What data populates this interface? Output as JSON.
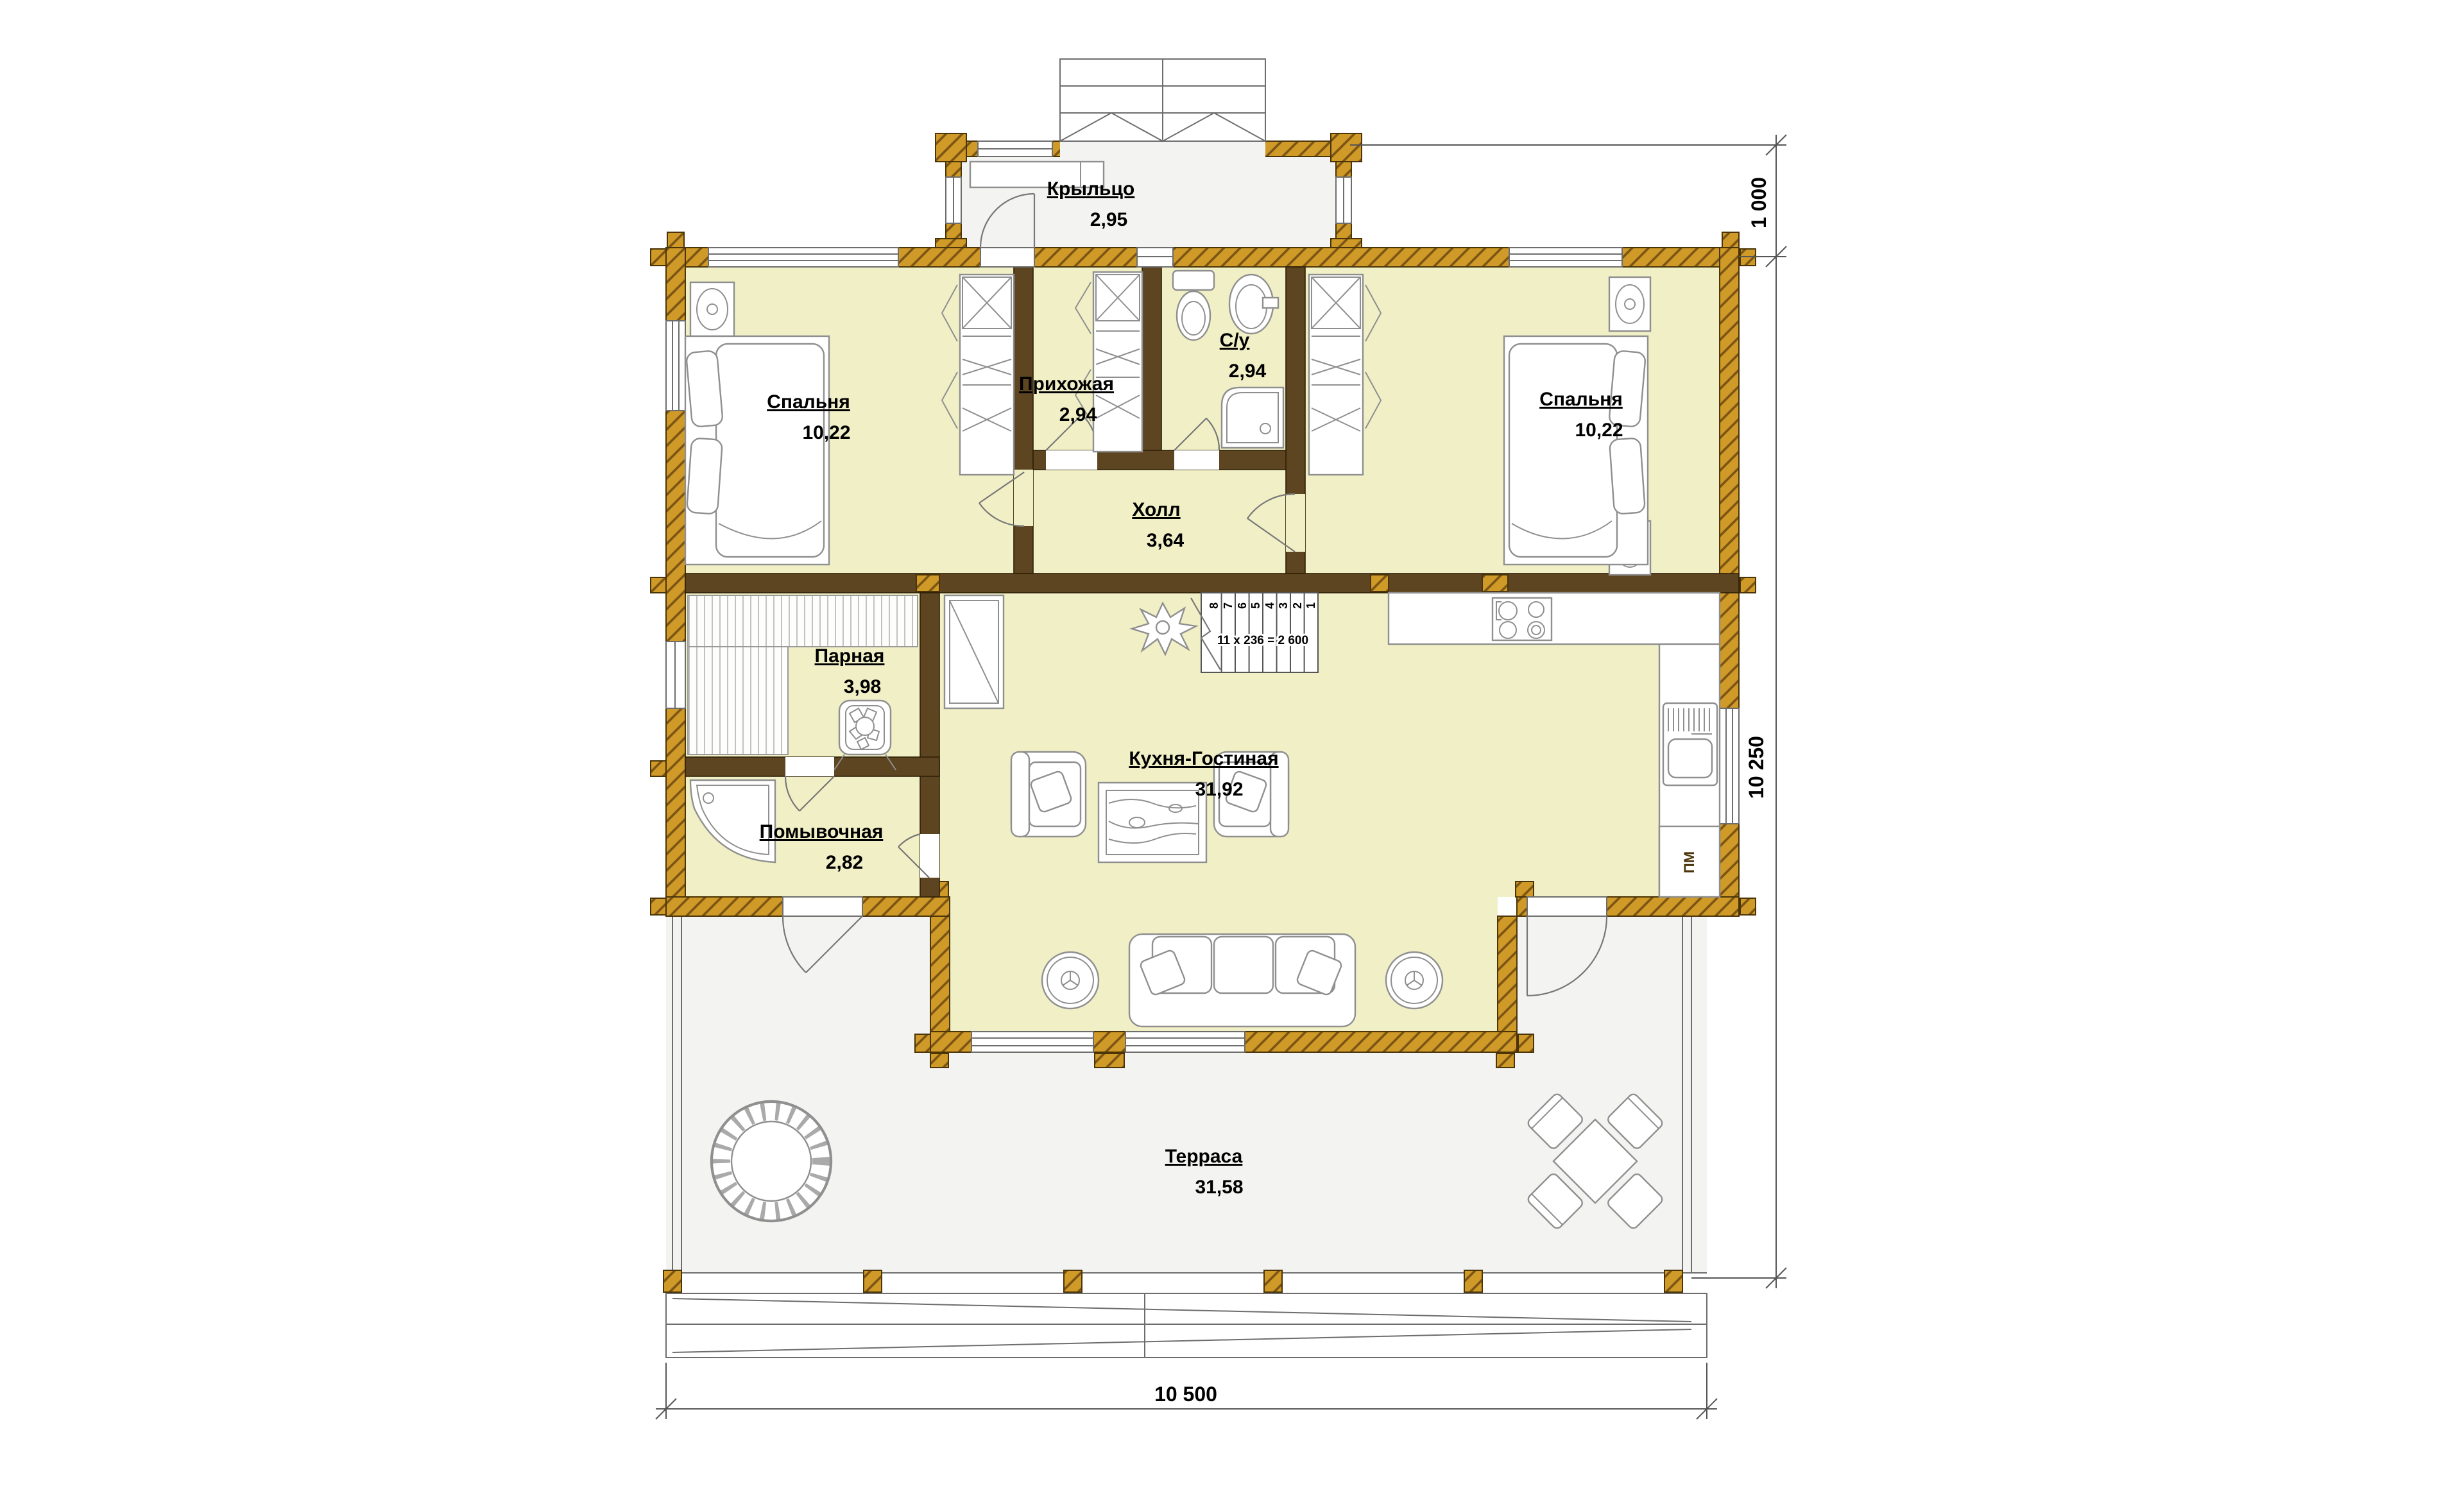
{
  "plan": {
    "rooms": {
      "porch": {
        "name": "Крыльцо",
        "area": "2,95"
      },
      "hallway": {
        "name": "Прихожая",
        "area": "2,94"
      },
      "bathroom": {
        "name": "С/у",
        "area": "2,94"
      },
      "bedroom_left": {
        "name": "Спальня",
        "area": "10,22"
      },
      "bedroom_right": {
        "name": "Спальня",
        "area": "10,22"
      },
      "hall": {
        "name": "Холл",
        "area": "3,64"
      },
      "sauna": {
        "name": "Парная",
        "area": "3,98"
      },
      "washroom": {
        "name": "Помывочная",
        "area": "2,82"
      },
      "kitchen_living": {
        "name": "Кухня-Гостиная",
        "area": "31,92"
      },
      "terrace": {
        "name": "Терраса",
        "area": "31,58"
      }
    },
    "dimensions": {
      "porch_depth": "1 000",
      "house_depth": "10 250",
      "total_width": "10 500"
    },
    "stairs": {
      "formula": "11 x 236 = 2 600",
      "treads": [
        "1",
        "2",
        "3",
        "4",
        "5",
        "6",
        "7",
        "8"
      ]
    },
    "appliances": {
      "dishwasher": "ПМ"
    },
    "colors": {
      "log_wall": "#d09a28",
      "partition": "#5e4521",
      "room_fill": "#f0efc6",
      "terrace_fill": "#f3f3f1"
    }
  }
}
